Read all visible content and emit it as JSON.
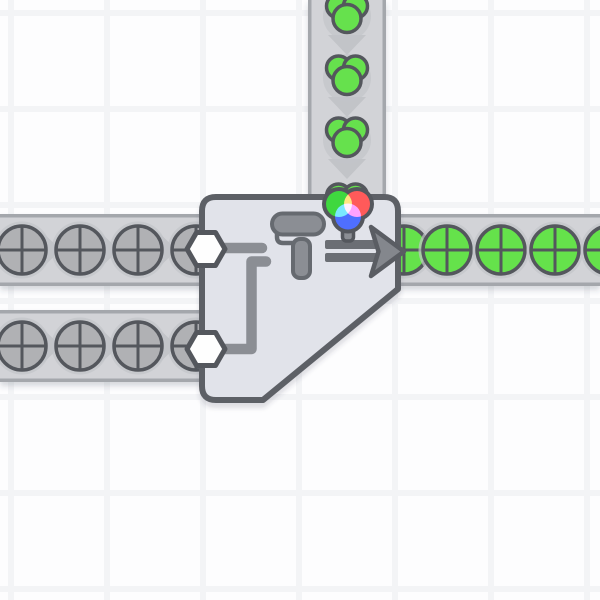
{
  "scene": {
    "grid": {
      "cell_color": "#fdfdfe",
      "line_color": "#f3f4f6",
      "cell_size": 96,
      "line_width": 6,
      "offset_x": 8,
      "offset_y": 10
    },
    "colors": {
      "belt_surface": "#d2d3d7",
      "belt_edge": "#a4a7ac",
      "belt_chevron": "#c2c4c8",
      "item_halo": "#c2c4c9",
      "item_outline": "#54575d",
      "shape_uncolored": "#b0b1b4",
      "shape_green": "#65e24b",
      "color_green": "#66e14d",
      "building_fill": "#e1e3ea",
      "building_outline": "#5d6066",
      "pipe": "#8b8e94",
      "icon_dark": "#666a70",
      "arrow_bars": "#6b6e74",
      "arrow_fill": "#84878d",
      "arrow_outline": "#5a5d63",
      "hexagon_fill": "#fefefe",
      "wheel_red": "#ff5a5a",
      "wheel_green": "#3fd83f",
      "wheel_blue": "#4f6fff"
    },
    "belts": [
      {
        "id": "color-input-belt-top",
        "direction": "down",
        "x": 308,
        "y": 0,
        "width": 78,
        "height": 202,
        "chevrons": [
          [
            347,
            45
          ],
          [
            347,
            107
          ],
          [
            347,
            169
          ]
        ],
        "items": [
          {
            "type": "color-green",
            "x": 347,
            "y": 14
          },
          {
            "type": "color-green",
            "x": 347,
            "y": 76
          },
          {
            "type": "color-green",
            "x": 347,
            "y": 138
          },
          {
            "type": "color-green",
            "x": 347,
            "y": 204,
            "halo": false
          }
        ]
      },
      {
        "id": "shape-input-belt-upper",
        "direction": "right",
        "x": 0,
        "y": 214,
        "width": 212,
        "height": 72,
        "chevrons": [
          [
            51,
            250
          ],
          [
            109,
            250
          ],
          [
            167,
            250
          ]
        ],
        "items": [
          {
            "type": "shape-circle-gray",
            "x": 22,
            "y": 250
          },
          {
            "type": "shape-circle-gray",
            "x": 80,
            "y": 250
          },
          {
            "type": "shape-circle-gray",
            "x": 138,
            "y": 250
          },
          {
            "type": "shape-circle-gray",
            "x": 196,
            "y": 250
          }
        ]
      },
      {
        "id": "shape-input-belt-lower",
        "direction": "right",
        "x": 0,
        "y": 310,
        "width": 212,
        "height": 72,
        "chevrons": [
          [
            51,
            346
          ],
          [
            109,
            346
          ],
          [
            167,
            346
          ]
        ],
        "items": [
          {
            "type": "shape-circle-gray",
            "x": 22,
            "y": 346
          },
          {
            "type": "shape-circle-gray",
            "x": 80,
            "y": 346
          },
          {
            "type": "shape-circle-gray",
            "x": 138,
            "y": 346
          },
          {
            "type": "shape-circle-gray",
            "x": 196,
            "y": 346
          }
        ]
      },
      {
        "id": "output-belt-right",
        "direction": "right",
        "x": 388,
        "y": 214,
        "width": 212,
        "height": 72,
        "chevrons": [],
        "items": [
          {
            "type": "shape-circle-green",
            "x": 404,
            "y": 250
          },
          {
            "type": "shape-circle-green",
            "x": 447,
            "y": 250
          },
          {
            "type": "shape-circle-green",
            "x": 501,
            "y": 250
          },
          {
            "type": "shape-circle-green",
            "x": 555,
            "y": 250
          },
          {
            "type": "shape-circle-green",
            "x": 609,
            "y": 250
          }
        ]
      }
    ],
    "building": {
      "name": "Painter (Double)",
      "size_tiles": "2x2",
      "icon": "paint-roller",
      "inputs": [
        {
          "port": "upper-left",
          "accepts": "shape"
        },
        {
          "port": "lower-left",
          "accepts": "shape"
        },
        {
          "port": "top",
          "accepts": "color"
        }
      ],
      "output": {
        "port": "right",
        "produces": "painted-shape"
      },
      "current_color": "green"
    }
  }
}
